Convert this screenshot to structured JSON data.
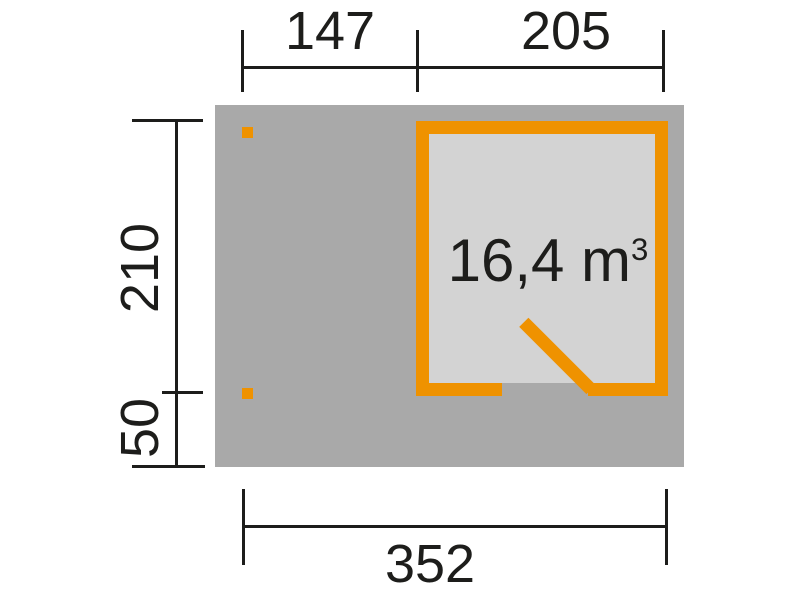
{
  "floorplan": {
    "volume": {
      "value": "16,4 m",
      "superscript": "3"
    },
    "dimensions": {
      "top_left": "147",
      "top_right": "205",
      "side_upper": "210",
      "side_lower": "50",
      "bottom": "352"
    }
  },
  "colors": {
    "wall_orange": "#ef9200",
    "terrace_gray": "#a9a9a9",
    "floor_gray": "#d3d3d3",
    "line_black": "#1d1d1b",
    "background": "#ffffff"
  }
}
